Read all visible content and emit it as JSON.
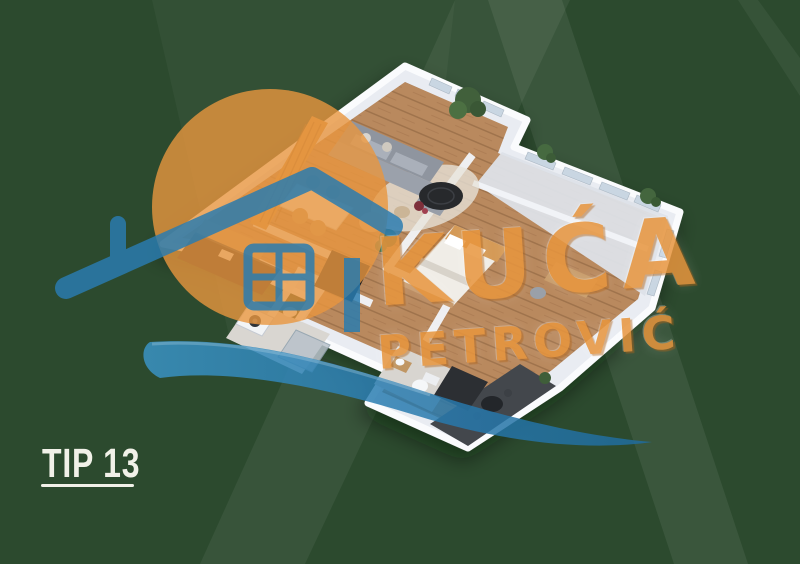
{
  "title": {
    "label": "TIP 13"
  },
  "watermark": {
    "brand_line1": "KUĆA",
    "brand_line2": "PETROVIĆ",
    "icon": "house-roof-icon",
    "swoosh_icon": "brush-swoosh-icon",
    "sun_icon": "orange-circle-icon"
  },
  "colors": {
    "background": "#2c4a2e",
    "brand_orange": "#e8963e",
    "brand_blue": "#2a7cb0",
    "title_text": "#f1f1e8",
    "wall": "#e9ecf2",
    "wood": "#b9895e"
  }
}
